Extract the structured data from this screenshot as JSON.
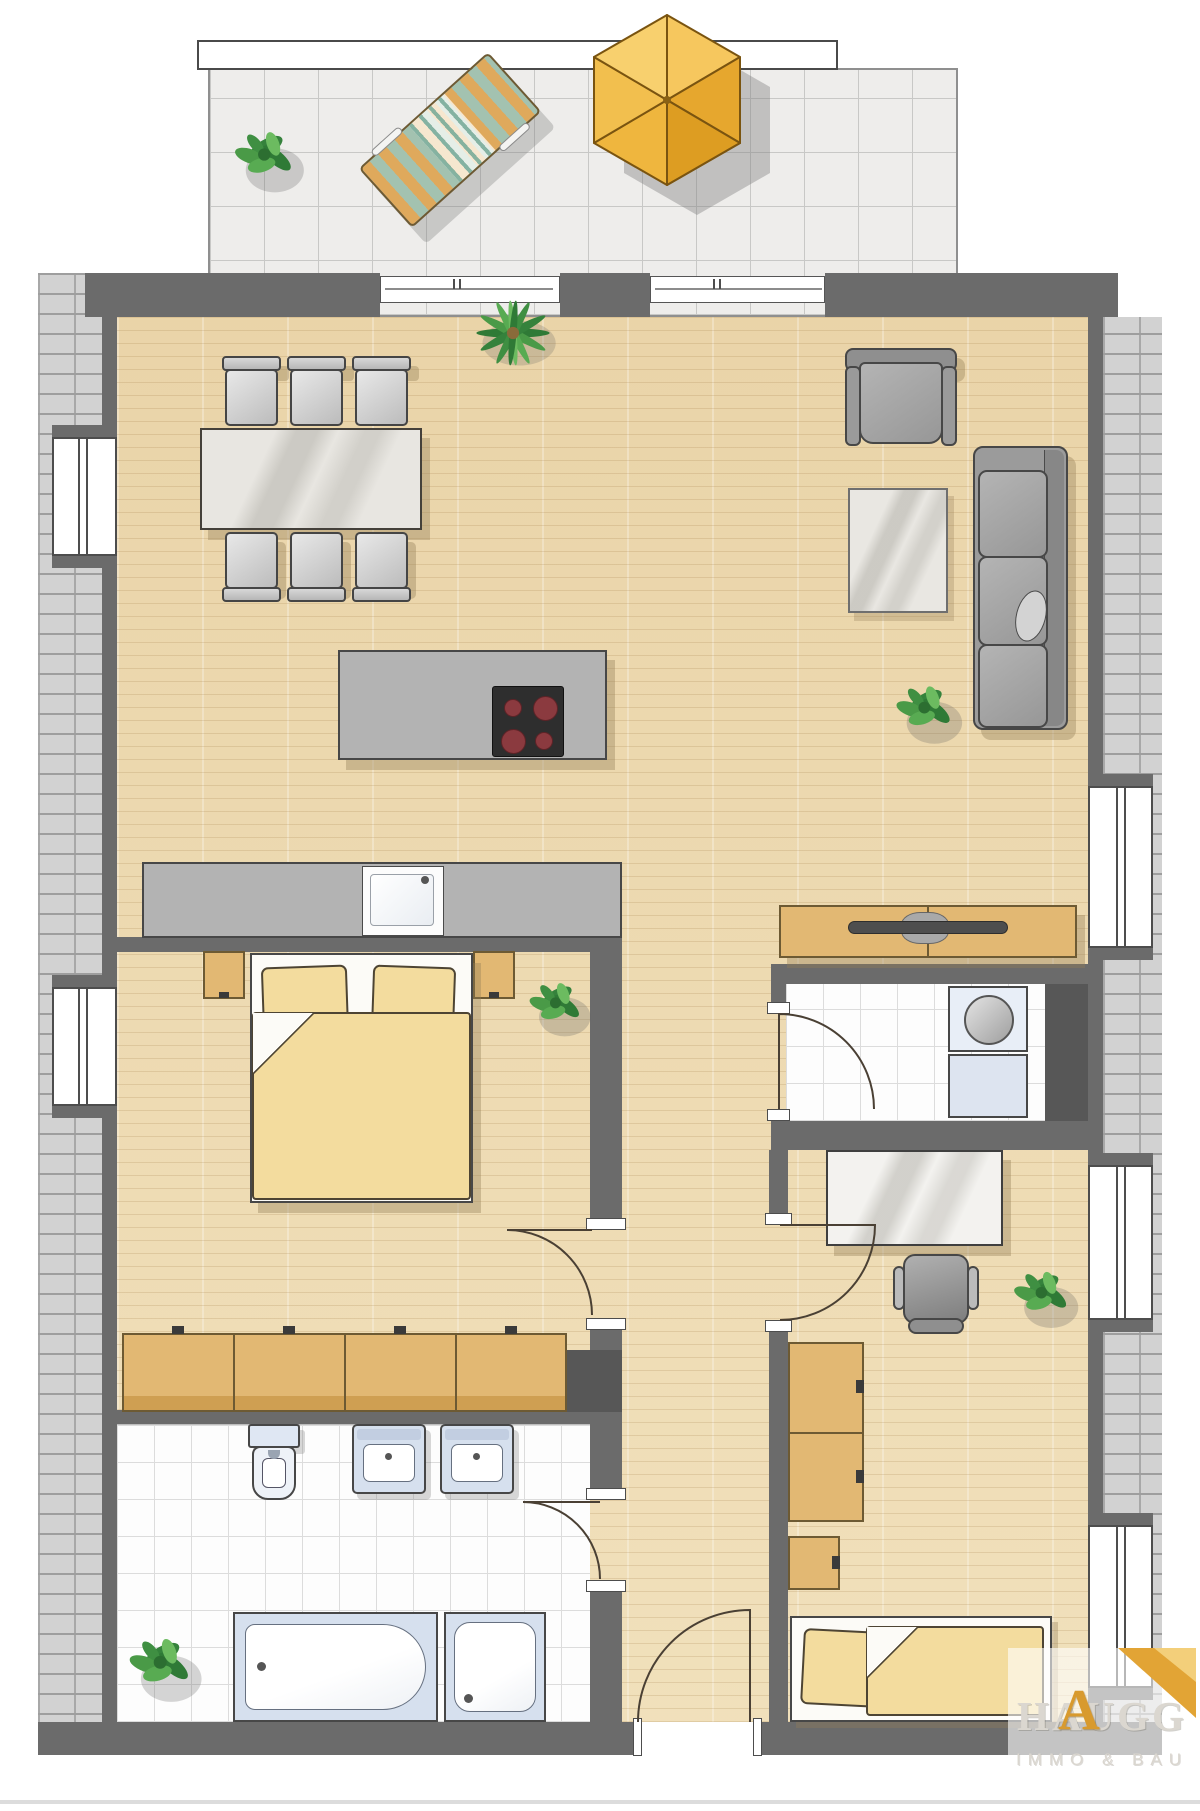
{
  "meta": {
    "type": "apartment-floor-plan",
    "view": "top-down"
  },
  "brand": {
    "name": "HAUGG",
    "accent_letter": "A",
    "tagline": "IMMO & BAU"
  },
  "colors": {
    "wall": "#6b6b6b",
    "wood": "#eedcb4",
    "tan": "#e2b873",
    "bedding": "#f3dc9e",
    "umbrella": "#efb63e",
    "gold": "#d89a2e",
    "sanitary": "#d6e0ee"
  },
  "rooms": [
    {
      "name": "balcony"
    },
    {
      "name": "living-dining-room"
    },
    {
      "name": "open-kitchen"
    },
    {
      "name": "master-bedroom"
    },
    {
      "name": "bathroom"
    },
    {
      "name": "utility-room"
    },
    {
      "name": "office-bedroom"
    },
    {
      "name": "hallway"
    }
  ],
  "furniture_icons": [
    "sun-umbrella",
    "lounge-chair",
    "potted-plant",
    "dining-table",
    "dining-chair",
    "kitchen-island-cooktop",
    "kitchen-counter-sink",
    "armchair",
    "sofa",
    "rug",
    "sideboard-tv",
    "double-bed",
    "nightstand",
    "wardrobe",
    "toilet",
    "washbasin",
    "bathtub",
    "shower",
    "washing-machine",
    "desk",
    "office-chair",
    "single-bed",
    "cabinet"
  ]
}
